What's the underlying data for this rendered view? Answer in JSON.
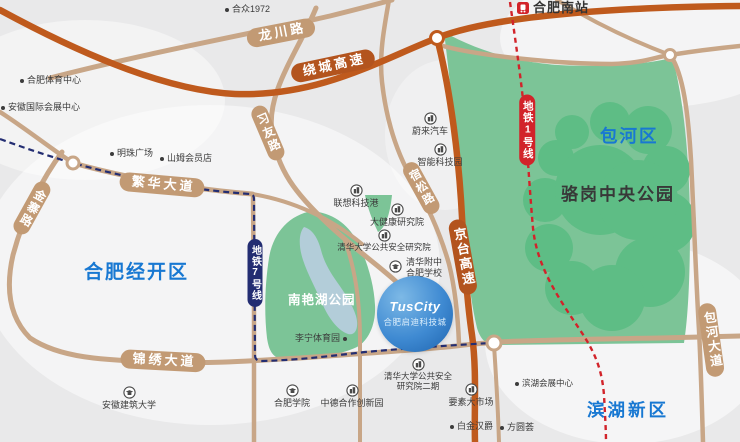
{
  "project": {
    "brand": "TusCity",
    "name": "合肥启迪科技城"
  },
  "districts": [
    {
      "label": "合肥经开区"
    },
    {
      "label": "包河区"
    },
    {
      "label": "滨湖新区"
    }
  ],
  "parks": [
    {
      "label": "骆岗中央公园"
    },
    {
      "label": "南艳湖公园"
    }
  ],
  "roads": [
    {
      "label": "龙川路",
      "type": "road"
    },
    {
      "label": "绕城高速",
      "type": "highway"
    },
    {
      "label": "习友路",
      "type": "road"
    },
    {
      "label": "繁华大道",
      "type": "road"
    },
    {
      "label": "金寨路",
      "type": "road"
    },
    {
      "label": "锦绣大道",
      "type": "road"
    },
    {
      "label": "宿松路",
      "type": "road"
    },
    {
      "label": "京台高速",
      "type": "highway"
    },
    {
      "label": "包河大道",
      "type": "road"
    }
  ],
  "metro": [
    {
      "label": "地铁7号线",
      "color": "#232d72"
    },
    {
      "label": "地铁1号线",
      "color": "#d2232a"
    }
  ],
  "station": {
    "label": "合肥南站"
  },
  "pois": [
    {
      "label": "合众1972",
      "type": "dot"
    },
    {
      "label": "合肥体育中心",
      "type": "dot"
    },
    {
      "label": "安徽国际会展中心",
      "type": "dot"
    },
    {
      "label": "明珠广场",
      "type": "dot"
    },
    {
      "label": "山姆会员店",
      "type": "dot"
    },
    {
      "label": "蔚来汽车",
      "type": "building"
    },
    {
      "label": "智能科技园",
      "type": "building"
    },
    {
      "label": "联想科技港",
      "type": "building"
    },
    {
      "label": "大健康研究院",
      "type": "building"
    },
    {
      "label": "清华大学公共安全研究院",
      "type": "building"
    },
    {
      "label": "清华附中\n合肥学校",
      "type": "school"
    },
    {
      "label": "李宁体育园",
      "type": "dot"
    },
    {
      "label": "安徽建筑大学",
      "type": "school"
    },
    {
      "label": "合肥学院",
      "type": "school"
    },
    {
      "label": "中德合作创新园",
      "type": "building"
    },
    {
      "label": "清华大学公共安全\n研究院二期",
      "type": "building"
    },
    {
      "label": "要素大市场",
      "type": "building"
    },
    {
      "label": "白金汉爵",
      "type": "dot"
    },
    {
      "label": "方圆荟",
      "type": "dot"
    },
    {
      "label": "滨湖会展中心",
      "type": "dot"
    }
  ],
  "colors": {
    "background": "#e9e9ea",
    "road_tan": "#c8a687",
    "road_orange": "#bf5a1d",
    "badge_tan": "#c29a74",
    "badge_orange": "#b3541e",
    "metro7": "#232d72",
    "metro1": "#d2232a",
    "park_green": "#7cc497",
    "park_green_dark": "#5ebd85",
    "lake": "#b3cdd9",
    "district_blue": "#1878d2"
  }
}
